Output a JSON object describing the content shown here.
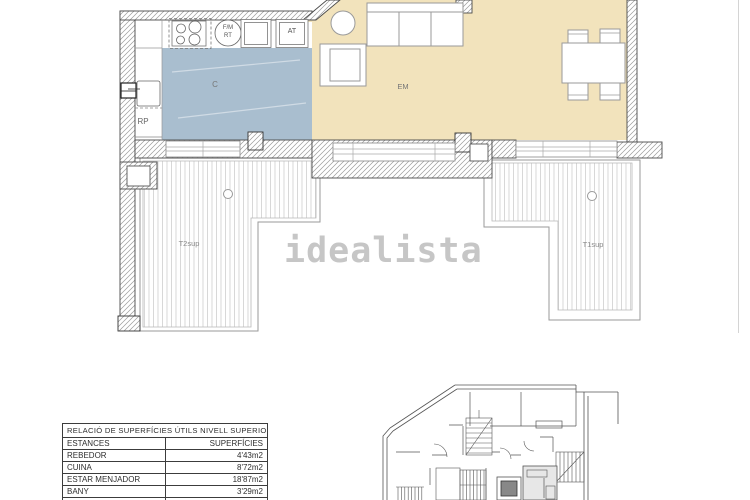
{
  "watermark": {
    "text": "idealista",
    "color": "#c6c6c6"
  },
  "floor_plan": {
    "rooms": {
      "kitchen": {
        "label": "C",
        "color": "#a9becf"
      },
      "living_dining": {
        "label": "EM",
        "color": "#f2e3bc"
      },
      "hall": {
        "label": "RP"
      },
      "closet": {
        "label": "AT"
      },
      "appliance_line1": {
        "label": "F/M"
      },
      "appliance_line2": {
        "label": "RT"
      },
      "terrace_left": {
        "label": "T2sup"
      },
      "terrace_right": {
        "label": "T1sup"
      }
    }
  },
  "areas_table": {
    "title": "RELACIÓ DE SUPERFÍCIES ÚTILS NIVELL SUPERIOR",
    "columns": {
      "room": "ESTANCES",
      "area": "SUPERFÍCIES"
    },
    "rows": [
      {
        "room": "REBEDOR",
        "area": "4'43m2"
      },
      {
        "room": "CUINA",
        "area": "8'72m2"
      },
      {
        "room": "ESTAR MENJADOR",
        "area": "18'87m2"
      },
      {
        "room": "BANY",
        "area": "3'29m2"
      }
    ]
  }
}
